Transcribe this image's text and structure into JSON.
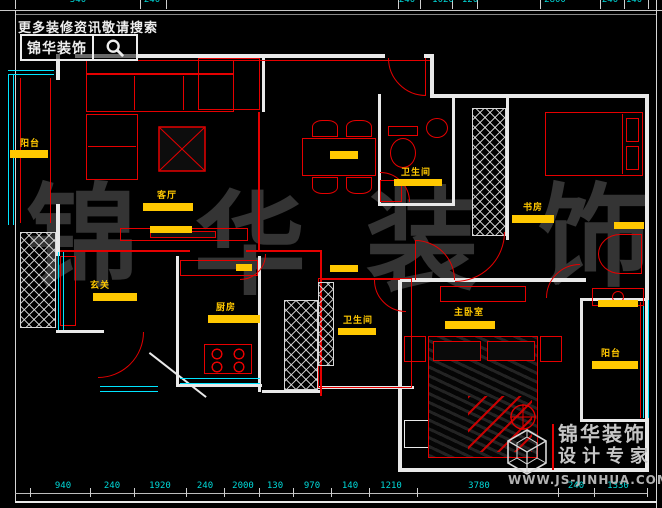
{
  "branding_top": {
    "tagline": "更多装修资讯敬请搜索",
    "brand": "锦华装饰"
  },
  "branding_bottom": {
    "brand": "锦华装饰",
    "subtitle": "设计专家",
    "website": "WWW.JS-JINHUA.COM"
  },
  "watermark": [
    "锦",
    "华",
    "装",
    "饰"
  ],
  "room_labels": [
    "阳台",
    "客厅",
    "玄关",
    "厨房",
    "卫生间",
    "书房",
    "卫生间",
    "主卧室",
    "阳台"
  ],
  "dimensions_top": [
    "540",
    "240",
    "240",
    "1020",
    "120",
    "2800",
    "240",
    "140"
  ],
  "dimensions_bottom": [
    "940",
    "240",
    "1920",
    "240",
    "2000",
    "130",
    "970",
    "140",
    "1210",
    "3780",
    "240",
    "1330"
  ],
  "colors": {
    "wall": "#e9e9e9",
    "red": "#e60000",
    "cyan": "#00e5ff",
    "label_yellow": "#ffc800",
    "dim_cyan": "#00d9d9",
    "watermark_gray": "#343434"
  }
}
